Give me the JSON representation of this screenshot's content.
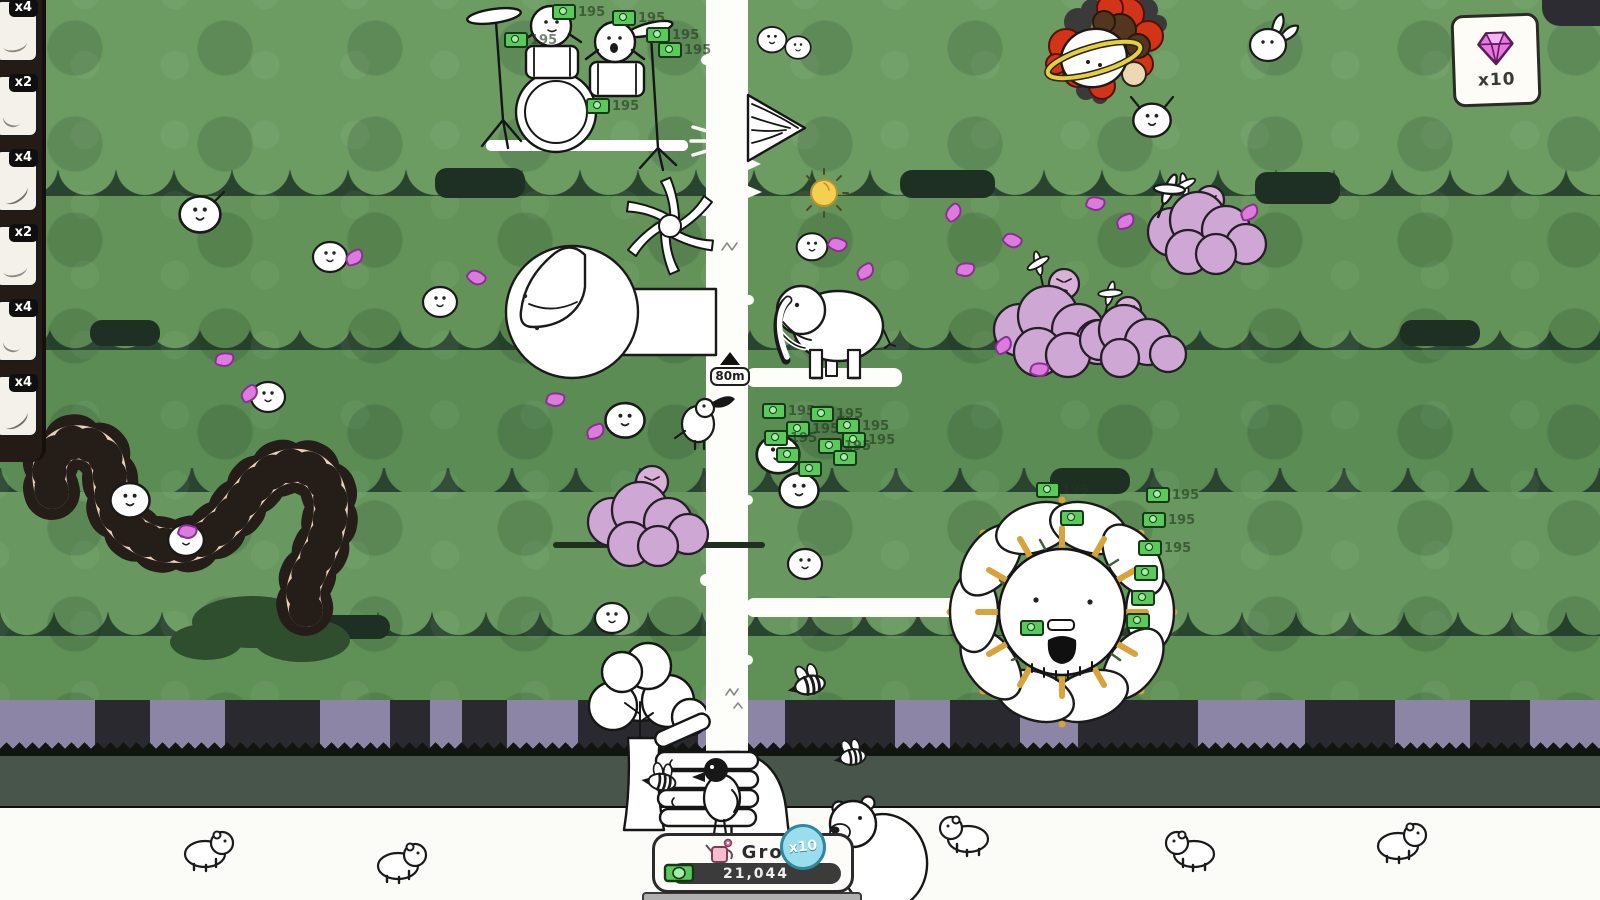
{
  "hud": {
    "sidebar": {
      "items": [
        {
          "multiplier": "x4"
        },
        {
          "multiplier": "x2"
        },
        {
          "multiplier": "x4"
        },
        {
          "multiplier": "x2"
        },
        {
          "multiplier": "x4"
        },
        {
          "multiplier": "x4"
        }
      ]
    },
    "gem_counter": {
      "icon": "gem-icon",
      "count_label": "x10"
    },
    "height_marker": {
      "label": "80m"
    },
    "grow_panel": {
      "button_label": "Grow",
      "currency_amount": "21,044",
      "icon": "watering-can-icon",
      "currency_icon": "money-icon"
    },
    "multiplier_bubble": {
      "label": "x10"
    }
  },
  "world": {
    "money_value": "195",
    "money_drops": [
      {
        "x": 552,
        "y": 4,
        "l": 1
      },
      {
        "x": 504,
        "y": 32,
        "l": 1
      },
      {
        "x": 612,
        "y": 10,
        "l": 1
      },
      {
        "x": 646,
        "y": 27,
        "l": 1
      },
      {
        "x": 658,
        "y": 42,
        "l": 1
      },
      {
        "x": 586,
        "y": 98,
        "l": 1
      },
      {
        "x": 762,
        "y": 403,
        "l": 1
      },
      {
        "x": 810,
        "y": 406,
        "l": 1
      },
      {
        "x": 786,
        "y": 421,
        "l": 1
      },
      {
        "x": 764,
        "y": 430,
        "l": 1
      },
      {
        "x": 836,
        "y": 418,
        "l": 1
      },
      {
        "x": 842,
        "y": 432,
        "l": 1
      },
      {
        "x": 818,
        "y": 438,
        "l": 1
      },
      {
        "x": 833,
        "y": 450,
        "l": 0
      },
      {
        "x": 776,
        "y": 447,
        "l": 0
      },
      {
        "x": 798,
        "y": 461,
        "l": 0
      },
      {
        "x": 1036,
        "y": 482,
        "l": 1
      },
      {
        "x": 1146,
        "y": 487,
        "l": 1
      },
      {
        "x": 1142,
        "y": 512,
        "l": 1
      },
      {
        "x": 1138,
        "y": 540,
        "l": 1
      },
      {
        "x": 1134,
        "y": 565,
        "l": 0
      },
      {
        "x": 1131,
        "y": 590,
        "l": 0
      },
      {
        "x": 1126,
        "y": 613,
        "l": 0
      },
      {
        "x": 1020,
        "y": 620,
        "l": 0
      },
      {
        "x": 1060,
        "y": 510,
        "l": 0
      }
    ],
    "petals": [
      {
        "x": 345,
        "y": 250,
        "r": -20
      },
      {
        "x": 467,
        "y": 270,
        "r": 40
      },
      {
        "x": 215,
        "y": 352,
        "r": 10
      },
      {
        "x": 240,
        "y": 386,
        "r": -30
      },
      {
        "x": 546,
        "y": 392,
        "r": 15
      },
      {
        "x": 586,
        "y": 424,
        "r": -15
      },
      {
        "x": 828,
        "y": 237,
        "r": 30
      },
      {
        "x": 856,
        "y": 264,
        "r": -25
      },
      {
        "x": 956,
        "y": 262,
        "r": 10
      },
      {
        "x": 944,
        "y": 205,
        "r": -40
      },
      {
        "x": 1086,
        "y": 196,
        "r": 20
      },
      {
        "x": 1116,
        "y": 214,
        "r": -15
      },
      {
        "x": 1003,
        "y": 233,
        "r": 35
      },
      {
        "x": 994,
        "y": 338,
        "r": -30
      },
      {
        "x": 1030,
        "y": 362,
        "r": 15
      },
      {
        "x": 178,
        "y": 524,
        "r": 20
      },
      {
        "x": 1240,
        "y": 205,
        "r": -20
      }
    ]
  },
  "colors": {
    "money_green": "#5cc95c",
    "gem_pink": "#e878e0",
    "bubble_blue": "#9adeed",
    "cloud_purple": "#cfa7d4",
    "petal_pink": "#dd7ade",
    "centipede_tan": "#edd0bc",
    "band_purple": "#8d85a5",
    "canopy_green": "#6d9c63",
    "ray_orange": "#d9a33c"
  }
}
